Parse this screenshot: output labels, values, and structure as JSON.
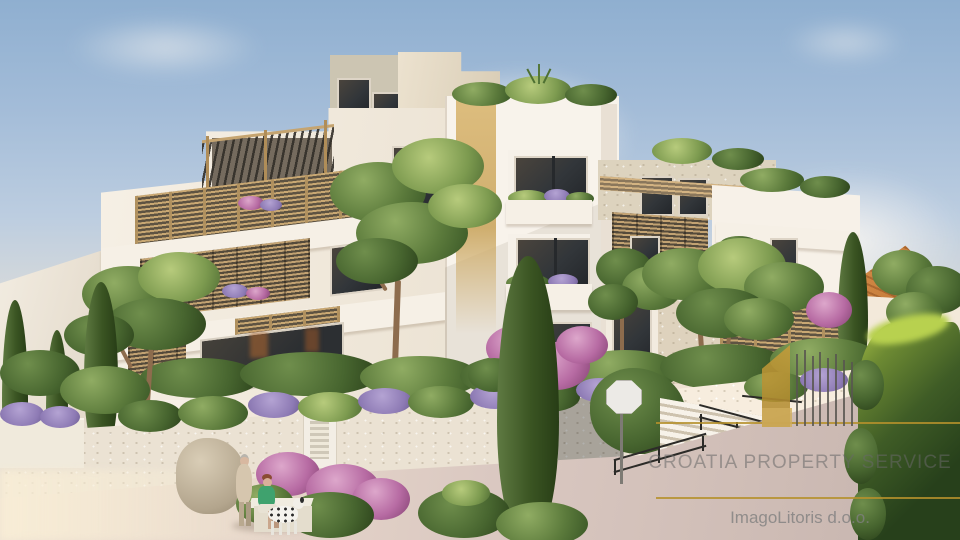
{
  "scene": {
    "type": "3d-architectural-rendering",
    "subject": "Modern terraced apartment building with wooden slat balconies and pergolas, rooftop plants, Mediterranean garden with lavender and pink shrubs, cypress and pine trees, stone retaining walls, access stairs with black railings, sloped driveway, neighbouring terracotta-roof house, and two people with a dalmatian at a bench"
  },
  "watermark": {
    "company": "CROATIA PROPERTY SERVICE",
    "credit": "ImagoLitoris d.o.o.",
    "accent_color": "#b5912c",
    "company_text_color": "#676767",
    "credit_text_color": "#808080",
    "logo_icon": "gold-sail-and-bars-logo"
  },
  "palette": {
    "sky_top": "#8fafd0",
    "sky_horizon": "#f1e4d3",
    "cloud_white": "#fdf9f4",
    "facade_white": "#f5efe4",
    "facade_shadow": "#ddd2c2",
    "wood_slat": "#c9a873",
    "pergola_dark": "#3a352e",
    "glass_dark": "#34383b",
    "accent_strip_tan": "#d7b678",
    "foliage_green": "#5c7b3c",
    "cypress_green": "#3a5422",
    "lavender": "#8d7ab4",
    "flower_pink": "#b76ba3",
    "stone_wall": "#ebe2d3",
    "road": "#d9c8c2",
    "hedge_dark": "#2c4420",
    "roof_terracotta": "#c9823f"
  }
}
